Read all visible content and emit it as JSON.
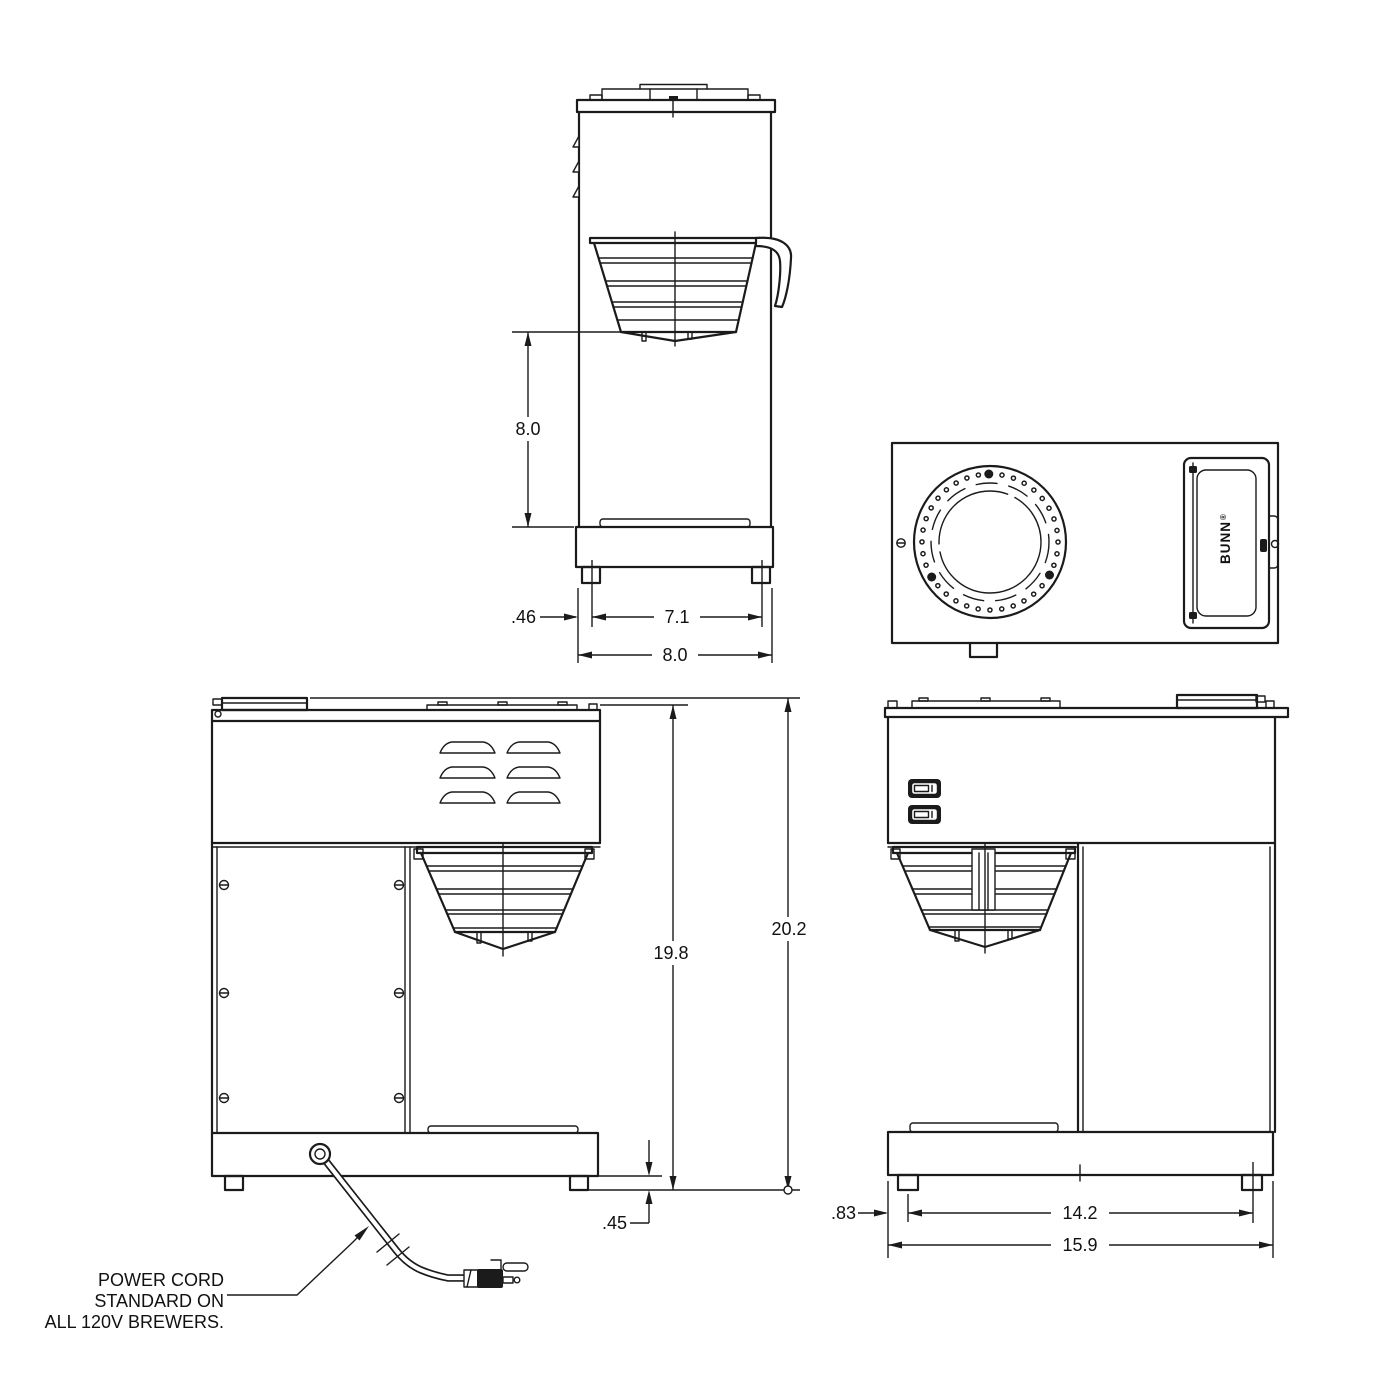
{
  "labels": {
    "brand": "BUNN",
    "brand_reg": "®",
    "power_cord_note": {
      "line1": "POWER CORD",
      "line2": "STANDARD ON",
      "line3": "ALL 120V BREWERS."
    }
  },
  "dimensions": {
    "front": {
      "funnel_to_base": "8.0",
      "foot_inset": ".46",
      "feet_span": "7.1",
      "overall_width": "8.0"
    },
    "side": {
      "body_height": "19.8",
      "overall_height": "20.2",
      "foot_height": ".45",
      "foot_inset": ".83",
      "feet_span": "14.2",
      "overall_depth": "15.9"
    }
  },
  "colors": {
    "ink": "#1b1b1b",
    "background": "#ffffff"
  }
}
